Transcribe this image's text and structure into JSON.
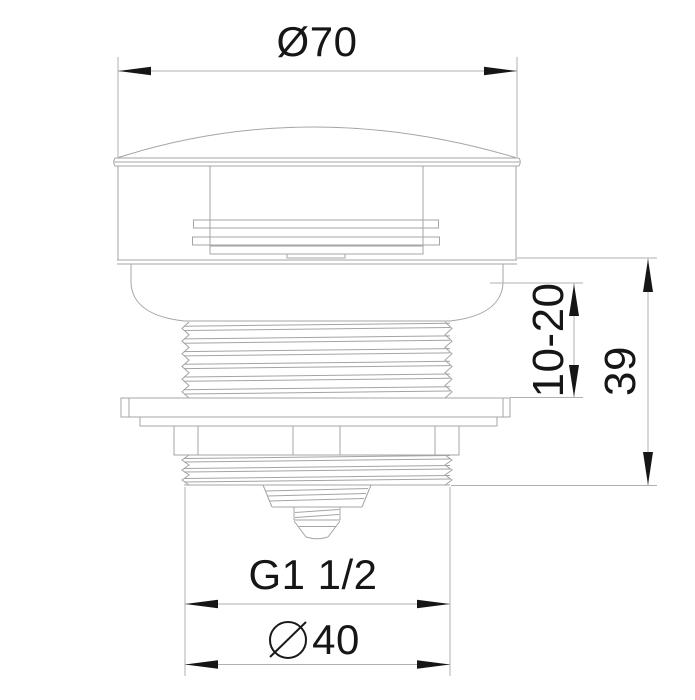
{
  "drawing": {
    "labels": {
      "cap_diameter": "Ø70",
      "mount_thickness": "10-20",
      "height": "39",
      "thread": "G1 1/2",
      "outlet_diameter": "40"
    },
    "colors": {
      "background": "#ffffff",
      "part_outline": "#a4a4a4",
      "dimension_line": "#b0b0b0",
      "annotation": "#161616"
    }
  }
}
